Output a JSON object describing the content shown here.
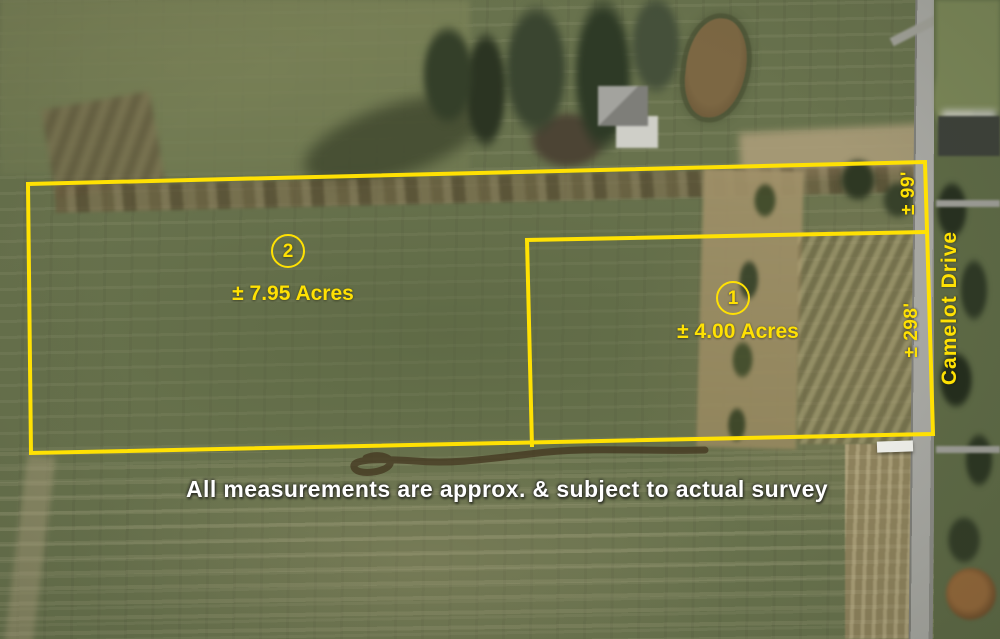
{
  "map": {
    "type": "aerial-parcel-survey-map",
    "disclaimer": "All measurements are approx. & subject to actual survey",
    "road": {
      "name": "Camelot Drive"
    },
    "parcels": [
      {
        "number": "1",
        "acreage": "± 4.00 Acres",
        "road_frontage": "± 298'"
      },
      {
        "number": "2",
        "acreage": "± 7.95 Acres",
        "road_frontage": "± 99'"
      }
    ],
    "colors": {
      "annotation_yellow": "#ffe103",
      "disclaimer_white": "#ffffff"
    }
  }
}
